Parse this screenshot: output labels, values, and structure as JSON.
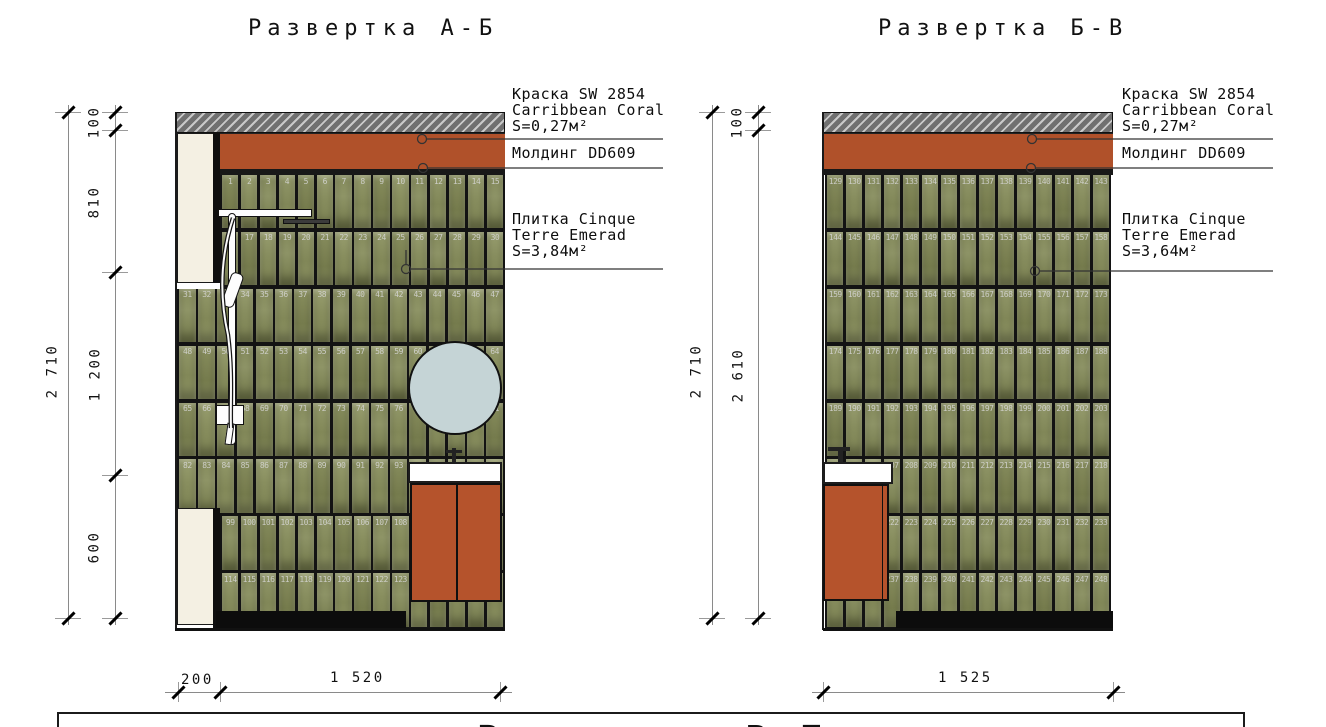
{
  "titles": {
    "left": "Развертка А-Б",
    "right": "Развертка Б-В"
  },
  "annotations": {
    "left": {
      "paint_l1": "Краска SW 2854",
      "paint_l2": "Carribbean Coral",
      "paint_l3": "S=0,27м²",
      "molding": "Молдинг DD609",
      "tile_l1": "Плитка Cinque",
      "tile_l2": "Terre Emerad",
      "tile_l3": "S=3,84м²"
    },
    "right": {
      "paint_l1": "Краска SW 2854",
      "paint_l2": "Carribbean Coral",
      "paint_l3": "S=0,27м²",
      "molding": "Молдинг DD609",
      "tile_l1": "Плитка Cinque",
      "tile_l2": "Terre Emerad",
      "tile_l3": "S=3,64м²"
    }
  },
  "dims": {
    "left": {
      "total": "2 710",
      "seg_100": "100",
      "seg_810": "810",
      "seg_1200": "1 200",
      "seg_600": "600",
      "bottom_200": "200",
      "bottom_1520": "1 520"
    },
    "right": {
      "total": "2 710",
      "seg_100": "100",
      "seg_2610": "2 610",
      "bottom_1525": "1 525"
    },
    "edge_partial": "2 710"
  },
  "walls": {
    "left": {
      "rows": [
        {
          "start": 1,
          "end": 15,
          "indent": true
        },
        {
          "start": 16,
          "end": 30,
          "indent": true
        },
        {
          "start": 31,
          "end": 47
        },
        {
          "start": 48,
          "end": 64
        },
        {
          "start": 65,
          "end": 81
        },
        {
          "start": 82,
          "end": 98
        },
        {
          "start": 99,
          "end": 113,
          "indent": true
        },
        {
          "start": 114,
          "end": 128,
          "indent": true
        }
      ],
      "dark_numbers": [
        94,
        95,
        96,
        97,
        98
      ]
    },
    "right": {
      "rows": [
        {
          "start": 129,
          "end": 143
        },
        {
          "start": 144,
          "end": 158
        },
        {
          "start": 159,
          "end": 173
        },
        {
          "start": 174,
          "end": 188
        },
        {
          "start": 189,
          "end": 203
        },
        {
          "start": 204,
          "end": 218
        },
        {
          "start": 219,
          "end": 233
        },
        {
          "start": 234,
          "end": 248
        }
      ],
      "dark_numbers": [
        204,
        205,
        206
      ]
    }
  },
  "bottom_panel": {
    "caption": "Развертка В-Г"
  },
  "colors": {
    "paint_orange": "#b0512a",
    "cabinet_orange": "#b5532c",
    "tile_green": "#8a9060",
    "molding_dark": "#181818",
    "mirror_blue": "#c5d4d6",
    "panel_cream": "#f4f0e3",
    "hatch_gray": "#707070"
  }
}
